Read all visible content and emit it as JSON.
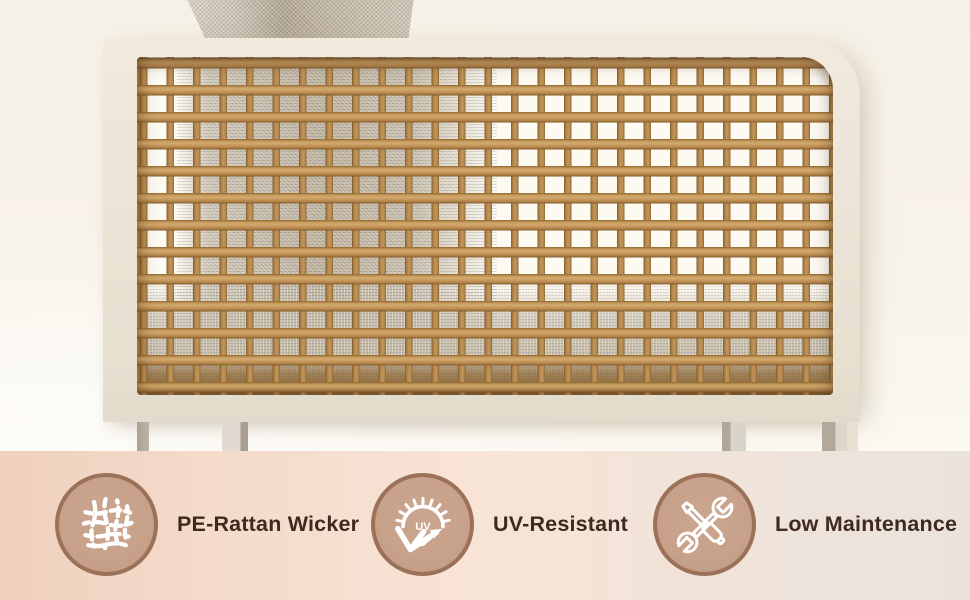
{
  "features": [
    {
      "label": "PE-Rattan Wicker",
      "icon": "wicker-weave-icon"
    },
    {
      "label": "UV-Resistant",
      "icon": "uv-sun-reflect-icon",
      "icon_text": "UV"
    },
    {
      "label": "Low Maintenance",
      "icon": "crossed-tools-icon"
    }
  ],
  "colors": {
    "badge_fill": "#c7a189",
    "badge_border": "#9b7158",
    "badge_icon": "#ffffff",
    "label_text": "#3f2a1f",
    "band_gradient_left": "#f0d0be",
    "band_gradient_mid": "#f8e4d7",
    "band_gradient_right": "#eae3dc",
    "frame": "#ece4d6",
    "rattan": "#c2955b",
    "cushion_fabric": "#beb2a0",
    "background": "#f7f2e9"
  }
}
